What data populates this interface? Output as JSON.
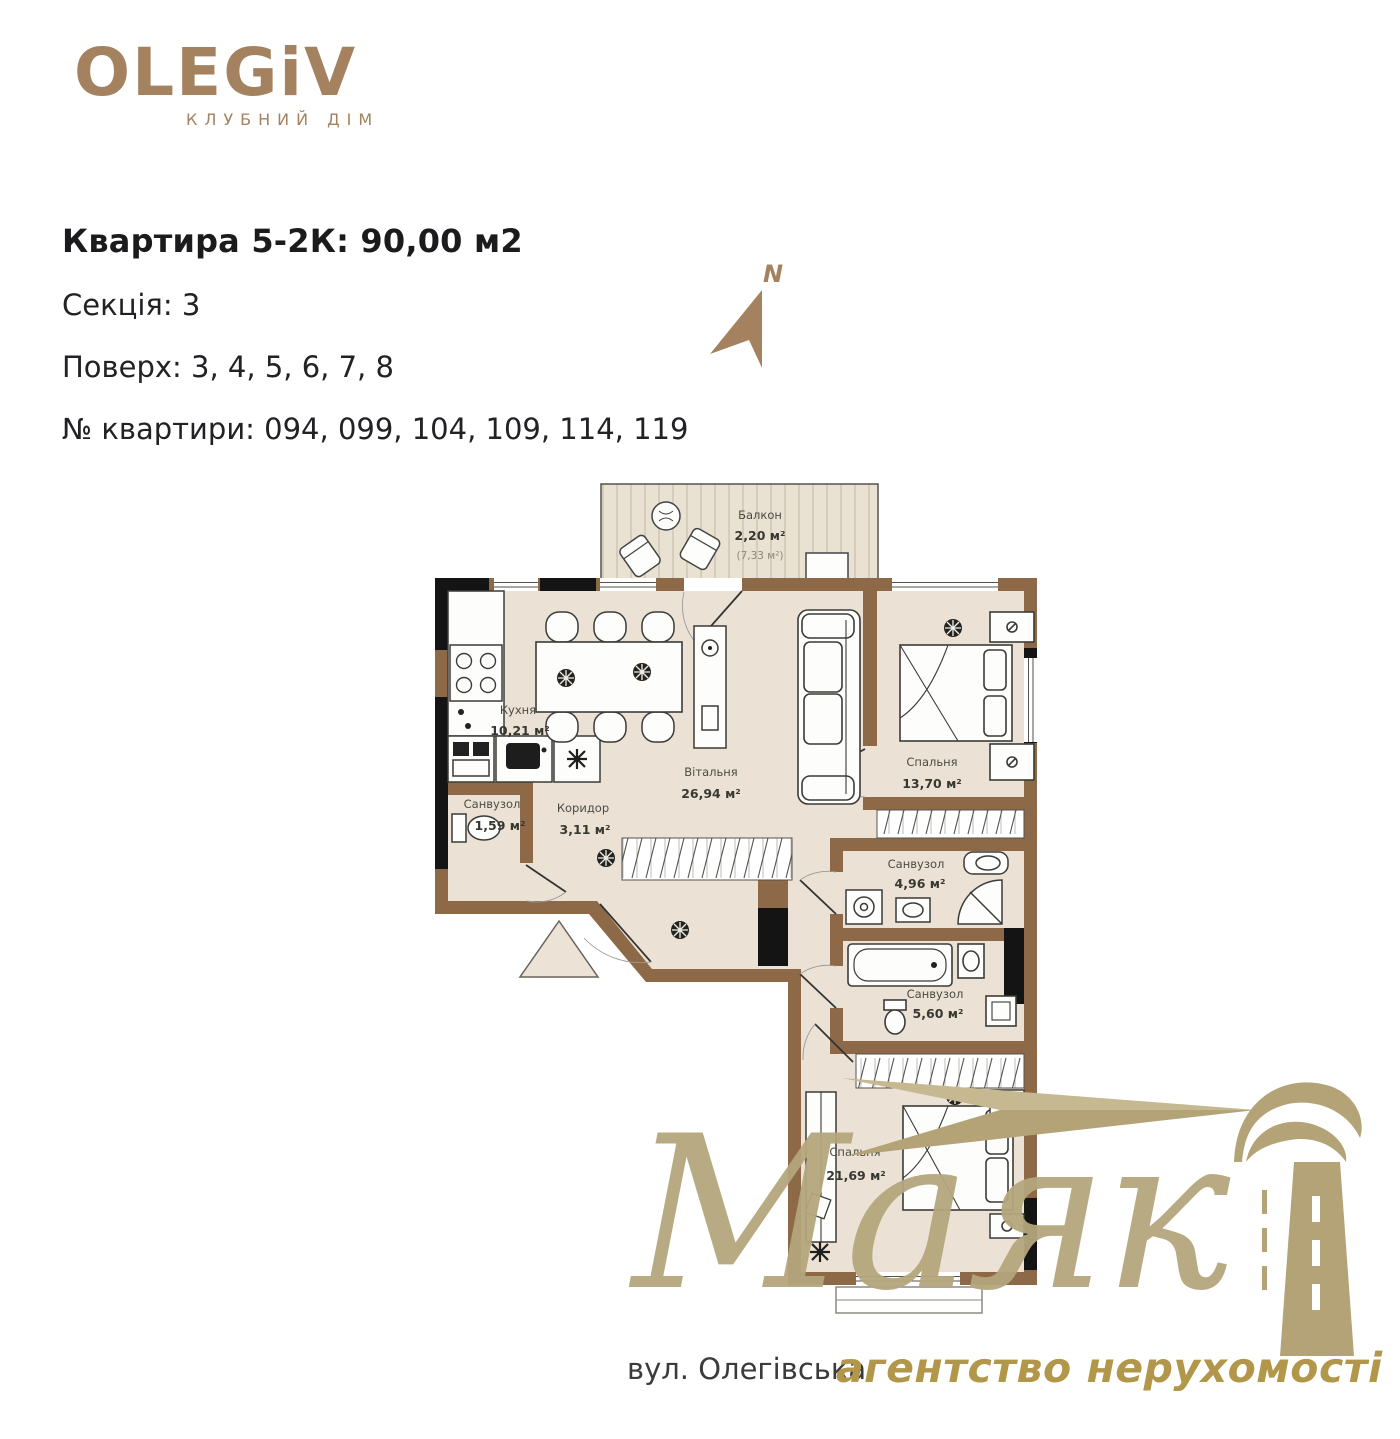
{
  "logo": {
    "brand": "OLEGiV",
    "subtitle": "КЛУБНИЙ ДІМ"
  },
  "header": {
    "title": "Квартира 5-2К: 90,00 м2",
    "section": "Секція: 3",
    "floors": "Поверх: 3, 4, 5, 6, 7, 8",
    "apartments": "№ квартири: 094, 099, 104, 109, 114, 119"
  },
  "compass": {
    "label": "N"
  },
  "plan": {
    "rooms": {
      "balcony": {
        "name": "Балкон",
        "area": "2,20 м²",
        "area_alt": "(7,33 м²)"
      },
      "kitchen": {
        "name": "Кухня",
        "area": "10,21 м²"
      },
      "living": {
        "name": "Вітальня",
        "area": "26,94 м²"
      },
      "bedroom1": {
        "name": "Спальня",
        "area": "13,70 м²"
      },
      "bath1": {
        "name": "Санвузол",
        "area": "1,59 м²"
      },
      "corridor": {
        "name": "Коридор",
        "area": "3,11 м²"
      },
      "bath2": {
        "name": "Санвузол",
        "area": "4,96 м²"
      },
      "bath3": {
        "name": "Санвузол",
        "area": "5,60 м²"
      },
      "bedroom2": {
        "name": "Спальня",
        "area": "21,69 м²"
      }
    }
  },
  "watermark": {
    "brand": "Маяк",
    "tagline": "агентство нерухомості"
  },
  "footer": {
    "street": "вул. Олегівська"
  },
  "colors": {
    "accent": "#a5825f",
    "wall": "#8d6947",
    "floor": "#ebe2d5",
    "gold": "#b3a377",
    "tagline_gold": "#b2964a"
  }
}
